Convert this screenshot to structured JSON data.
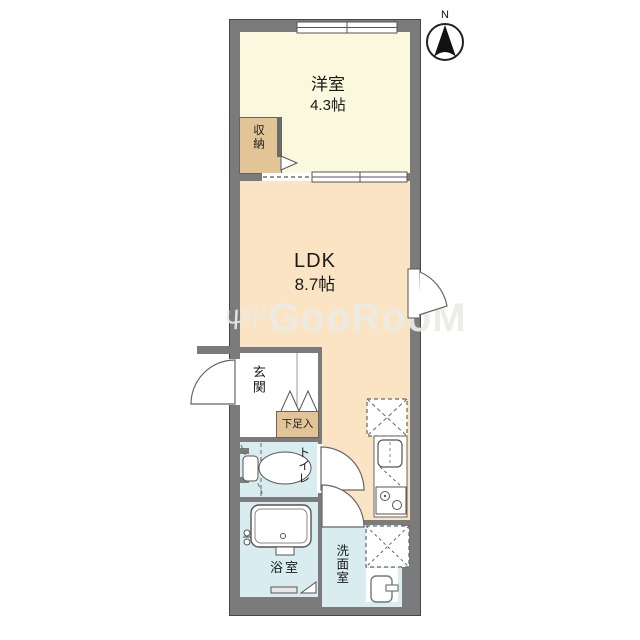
{
  "compass": {
    "north_label": "N"
  },
  "watermark": {
    "logo": "ΨΨ",
    "text": "GooRooM"
  },
  "rooms": {
    "western_room": {
      "label": "洋室",
      "size": "4.3帖"
    },
    "storage": {
      "label": "収納"
    },
    "ldk": {
      "label": "LDK",
      "size": "8.7帖"
    },
    "entrance": {
      "label": "玄関"
    },
    "shoe_cabinet": {
      "label": "下足入"
    },
    "toilet": {
      "label": "トイレ"
    },
    "bathroom": {
      "label": "浴室"
    },
    "washroom": {
      "label": "洗面室"
    }
  },
  "colors": {
    "wall": "#7b7b7b",
    "western_room": "#faf8dd",
    "ldk": "#fbe4c4",
    "storage": "#e2c496",
    "wet_area": "#d9edf1"
  }
}
